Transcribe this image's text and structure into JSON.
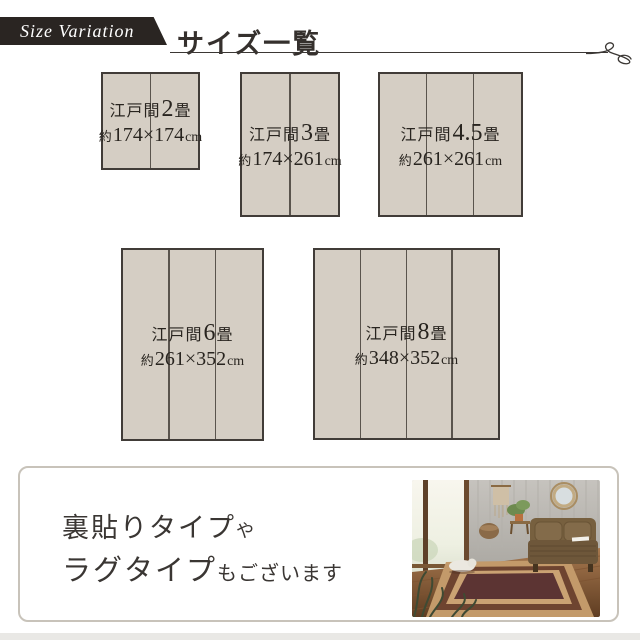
{
  "header": {
    "ribbon_label": "Size Variation",
    "title": "サイズ一覧"
  },
  "sizes": [
    {
      "id": "edoma-2jo",
      "name_prefix": "江戸間",
      "name_number": "2",
      "name_suffix": "畳",
      "dim_prefix": "約",
      "dim_value": "174×174",
      "dim_unit": "cm",
      "panels": 2
    },
    {
      "id": "edoma-3jo",
      "name_prefix": "江戸間",
      "name_number": "3",
      "name_suffix": "畳",
      "dim_prefix": "約",
      "dim_value": "174×261",
      "dim_unit": "cm",
      "panels": 2
    },
    {
      "id": "edoma-4-5jo",
      "name_prefix": "江戸間",
      "name_number": "4.5",
      "name_suffix": "畳",
      "dim_prefix": "約",
      "dim_value": "261×261",
      "dim_unit": "cm",
      "panels": 3
    },
    {
      "id": "edoma-6jo",
      "name_prefix": "江戸間",
      "name_number": "6",
      "name_suffix": "畳",
      "dim_prefix": "約",
      "dim_value": "261×352",
      "dim_unit": "cm",
      "panels": 3
    },
    {
      "id": "edoma-8jo",
      "name_prefix": "江戸間",
      "name_number": "8",
      "name_suffix": "畳",
      "dim_prefix": "約",
      "dim_value": "348×352",
      "dim_unit": "cm",
      "panels": 4
    }
  ],
  "note": {
    "line1_main": "裏貼りタイプ",
    "line1_small": "や",
    "line2_main": "ラグタイプ",
    "line2_small": "もございます"
  },
  "colors": {
    "mat_fill": "#d5cec4",
    "mat_border": "#413c38",
    "mat_line": "#5a544d",
    "ribbon_bg": "#2a2522",
    "ink": "#35302d",
    "note_border": "#c8c3ba",
    "strip_bg": "#e9e8e5"
  }
}
